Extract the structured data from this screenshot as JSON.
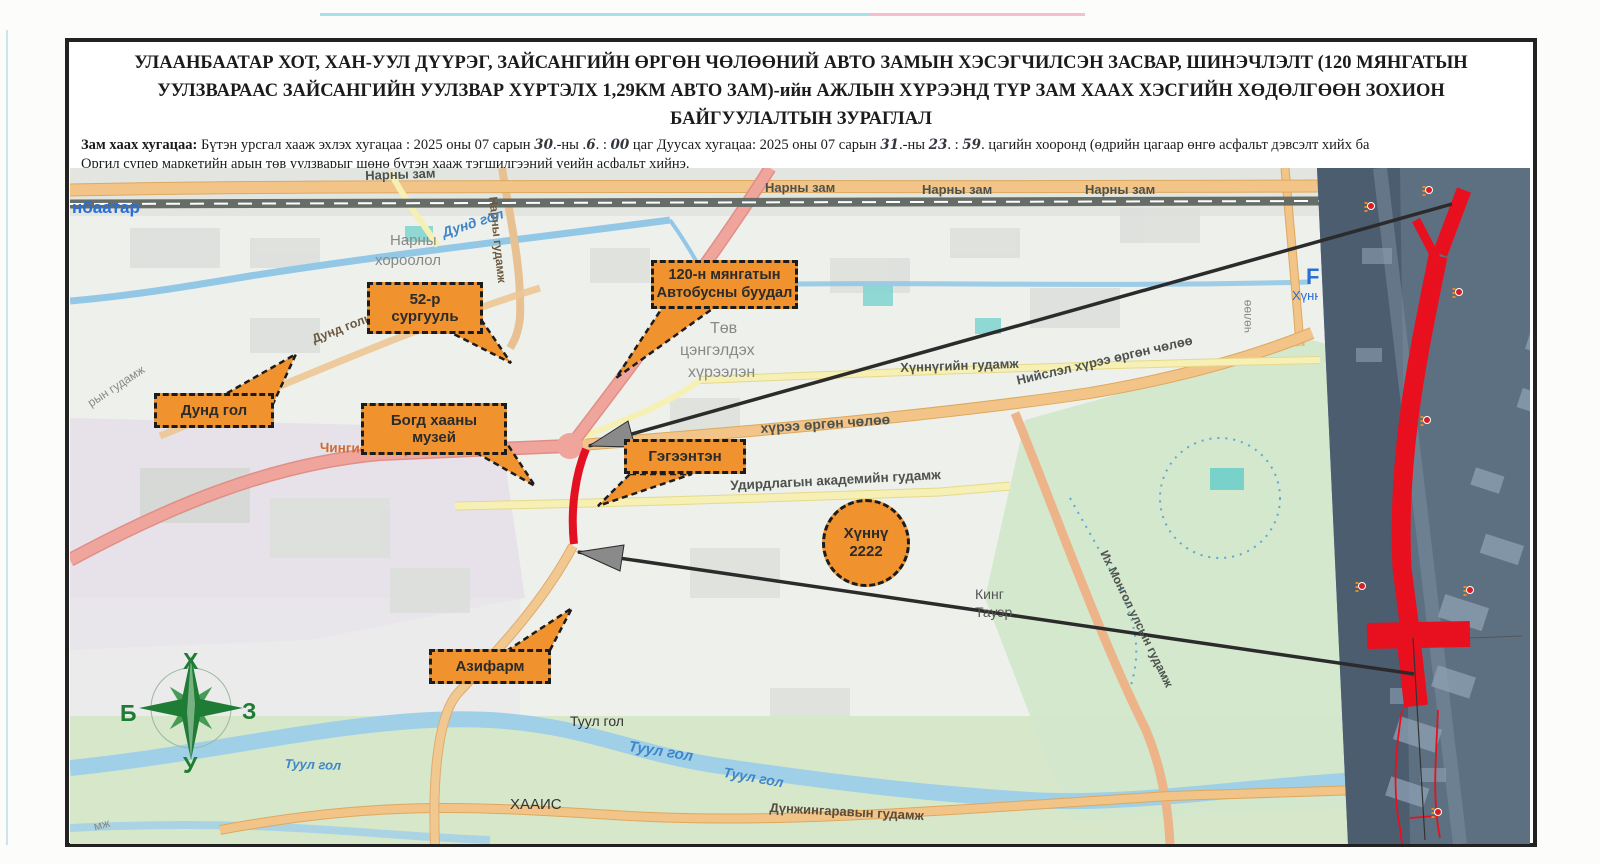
{
  "title": {
    "line1": "УЛААНБААТАР ХОТ, ХАН-УУЛ ДҮҮРЭГ, ЗАЙСАНГИЙН ӨРГӨН ЧӨЛӨӨНИЙ АВТО ЗАМЫН ХЭСЭГЧИЛСЭН ЗАСВАР, ШИНЭЧЛЭЛТ (120 МЯНГАТЫН",
    "line2": "УУЛЗВАРААС ЗАЙСАНГИЙН УУЛЗВАР ХҮРТЭЛХ 1,29КМ АВТО ЗАМ)-ийн АЖЛЫН ХҮРЭЭНД ТҮР ЗАМ ХААХ ХЭСГИЙН ХӨДӨЛГӨӨН ЗОХИОН",
    "line3": "БАЙГУУЛАЛТЫН ЗУРАГЛАЛ"
  },
  "subtitle": {
    "segments": [
      {
        "t": "Зам  хаах хугацаа:"
      },
      {
        "t": " Бүтэн урсгал хааж эхлэх хугацаа : 2025 оны 07 сарын "
      },
      {
        "t": "30"
      },
      {
        "t": ".-ны ."
      },
      {
        "t": "6"
      },
      {
        "t": ". : "
      },
      {
        "t": "00"
      },
      {
        "t": " цаг Дуусах хугацаа: 2025 оны 07 сарын "
      },
      {
        "t": "31"
      },
      {
        "t": ".-ны "
      },
      {
        "t": "23"
      },
      {
        "t": ". : "
      },
      {
        "t": "59"
      },
      {
        "t": ". цагийн хооронд (өдрийн цагаар өнгө асфальт дэвсэлт хийх ба"
      }
    ],
    "line2": "Оргил супер маркетийн арын төв уулзварыг шөнө бүтэн хааж тэгшилгээний үеийн асфальт хийнэ."
  },
  "map": {
    "labels": [
      {
        "text": "Нарны зам"
      },
      {
        "text": "Нарны зам"
      },
      {
        "text": "Нарны зам"
      },
      {
        "text": "Нарны зам"
      },
      {
        "text": "нбаатар"
      },
      {
        "text": "Нарны"
      },
      {
        "text": "хороолол"
      },
      {
        "text": "Нарны гудамж"
      },
      {
        "text": "Дунд гол"
      },
      {
        "text": "Дунд голын гудамж"
      },
      {
        "text": "Төв"
      },
      {
        "text": "цэнгэлдэх"
      },
      {
        "text": "хүрээлэн"
      },
      {
        "text": "Хүннүгийн гудамж"
      },
      {
        "text": "Нийслэл хүрээ өргөн чөлөө"
      },
      {
        "text": "хүрээ өргөн чөлөө"
      },
      {
        "text": "Удирдлагын академийн гудамж"
      },
      {
        "text": "Их Монгол улсын гудамж"
      },
      {
        "text": "Кинг"
      },
      {
        "text": "Тауэр"
      },
      {
        "text": "Туул гол"
      },
      {
        "text": "Туул гол"
      },
      {
        "text": "Туул гол"
      },
      {
        "text": "Туул гол"
      },
      {
        "text": "ХААИС"
      },
      {
        "text": "Дүнжингаравын гудамж"
      },
      {
        "text": "Чингисийн өргөн чөлөө"
      },
      {
        "text": "рын гудамж"
      },
      {
        "text": "F"
      },
      {
        "text": "Хүнн"
      },
      {
        "text": "чөлөө"
      },
      {
        "text": "мж"
      }
    ],
    "callouts": [
      {
        "label": "52-р сургууль"
      },
      {
        "line1": "120-н мянгатын",
        "line2": "Автобусны буудал"
      },
      {
        "label": "Дунд гол"
      },
      {
        "label": "Богд хааны музей"
      },
      {
        "label": "Гэгээнтэн"
      },
      {
        "line1": "Хүннү",
        "line2": "2222"
      },
      {
        "label": "Азифарм"
      }
    ],
    "compass": {
      "n": "Х",
      "e": "З",
      "w": "Б",
      "s": "У"
    }
  },
  "colors": {
    "callout_orange": "#f0922d",
    "closed_road_red": "#e31022",
    "compass_green": "#1e7c34",
    "pink_road": "#efa59c",
    "orange_road": "#f2c488",
    "river_blue": "#9fd0e8"
  }
}
